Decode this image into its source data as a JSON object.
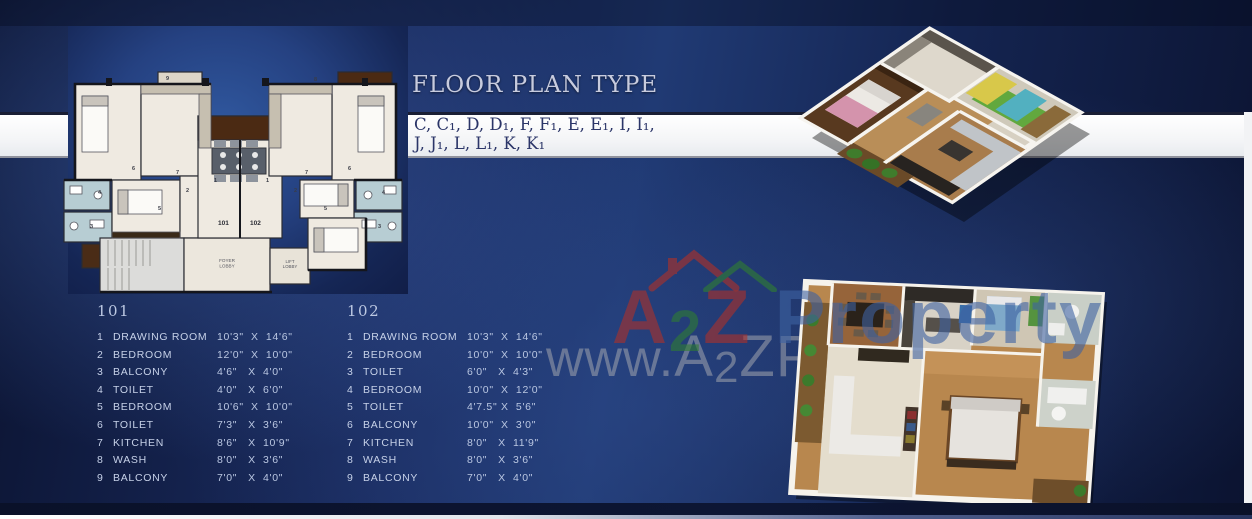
{
  "title": "FLOOR PLAN TYPE",
  "plan_types_line1": "C, C₁, D, D₁, F, F₁, E, E₁, I, I₁,",
  "plan_types_line2": "J, J₁, L, L₁, K, K₁",
  "colors": {
    "background_navy": "#16255a",
    "band_white": "#f4f5f7",
    "title_silver": "#c7cbde",
    "subtitle_navy": "#2b3568",
    "table_text": "#c6d1e8",
    "watermark_red": "#ad3129",
    "watermark_green": "#2f7d32",
    "watermark_blue": "#3e62a2",
    "balcony_brown": "#4b2a13",
    "toilet_blue": "#b7cdd3"
  },
  "floor_plan_2d": {
    "unit_left_label": "101",
    "unit_right_label": "102",
    "foyer_line1": "FOYER",
    "foyer_line2": "LOBBY",
    "lift_line1": "LIFT",
    "lift_line2": "LOBBY",
    "room_markers": [
      {
        "t": "9",
        "x": 104,
        "y": 10
      },
      {
        "t": "8",
        "x": 252,
        "y": 11
      },
      {
        "t": "7",
        "x": 114,
        "y": 104
      },
      {
        "t": "7",
        "x": 243,
        "y": 104
      },
      {
        "t": "6",
        "x": 70,
        "y": 100
      },
      {
        "t": "6",
        "x": 286,
        "y": 100
      },
      {
        "t": "5",
        "x": 96,
        "y": 140
      },
      {
        "t": "5",
        "x": 262,
        "y": 140
      },
      {
        "t": "2",
        "x": 124,
        "y": 122
      },
      {
        "t": "2",
        "x": 232,
        "y": 122
      },
      {
        "t": "1",
        "x": 152,
        "y": 112
      },
      {
        "t": "1",
        "x": 204,
        "y": 112
      },
      {
        "t": "4",
        "x": 36,
        "y": 124
      },
      {
        "t": "3",
        "x": 28,
        "y": 158
      },
      {
        "t": "3",
        "x": 316,
        "y": 158
      },
      {
        "t": "4",
        "x": 320,
        "y": 124
      }
    ]
  },
  "tables": [
    {
      "unit": "101",
      "rows": [
        [
          "1",
          "DRAWING ROOM",
          "10'3\"  X  14'6\""
        ],
        [
          "2",
          "BEDROOM",
          "12'0\"  X  10'0\""
        ],
        [
          "3",
          "BALCONY",
          "4'6\"   X  4'0\""
        ],
        [
          "4",
          "TOILET",
          "4'0\"   X  6'0\""
        ],
        [
          "5",
          "BEDROOM",
          "10'6\"  X  10'0\""
        ],
        [
          "6",
          "TOILET",
          "7'3\"   X  3'6\""
        ],
        [
          "7",
          "KITCHEN",
          "8'6\"   X  10'9\""
        ],
        [
          "8",
          "WASH",
          "8'0\"   X  3'6\""
        ],
        [
          "9",
          "BALCONY",
          "7'0\"   X  4'0\""
        ]
      ]
    },
    {
      "unit": "102",
      "rows": [
        [
          "1",
          "DRAWING ROOM",
          "10'3\"  X  14'6\""
        ],
        [
          "2",
          "BEDROOM",
          "10'0\"  X  10'0\""
        ],
        [
          "3",
          "TOILET",
          "6'0\"   X  4'3\""
        ],
        [
          "4",
          "BEDROOM",
          "10'0\"  X  12'0\""
        ],
        [
          "5",
          "TOILET",
          "4'7.5\" X  5'6\""
        ],
        [
          "6",
          "BALCONY",
          "10'0\"  X  3'0\""
        ],
        [
          "7",
          "KITCHEN",
          "8'0\"   X  11'9\""
        ],
        [
          "8",
          "WASH",
          "8'0\"   X  3'6\""
        ],
        [
          "9",
          "BALCONY",
          "7'0\"   X  4'0\""
        ]
      ]
    }
  ],
  "watermark": {
    "url_parts": [
      {
        "text": "www.",
        "cls": ""
      },
      {
        "text": "A",
        "cls": "big"
      },
      {
        "text": "2",
        "cls": "sub2"
      },
      {
        "text": "ZProperty",
        "cls": "big"
      }
    ],
    "logo_parts": [
      {
        "text": "A",
        "color": "#ad3129",
        "cls": ""
      },
      {
        "text": "2",
        "color": "#2f7d32",
        "cls": "sub2"
      },
      {
        "text": "Z",
        "color": "#ad3129",
        "cls": ""
      },
      {
        "text": " Property",
        "color": "#3e62a2",
        "cls": ""
      }
    ]
  }
}
